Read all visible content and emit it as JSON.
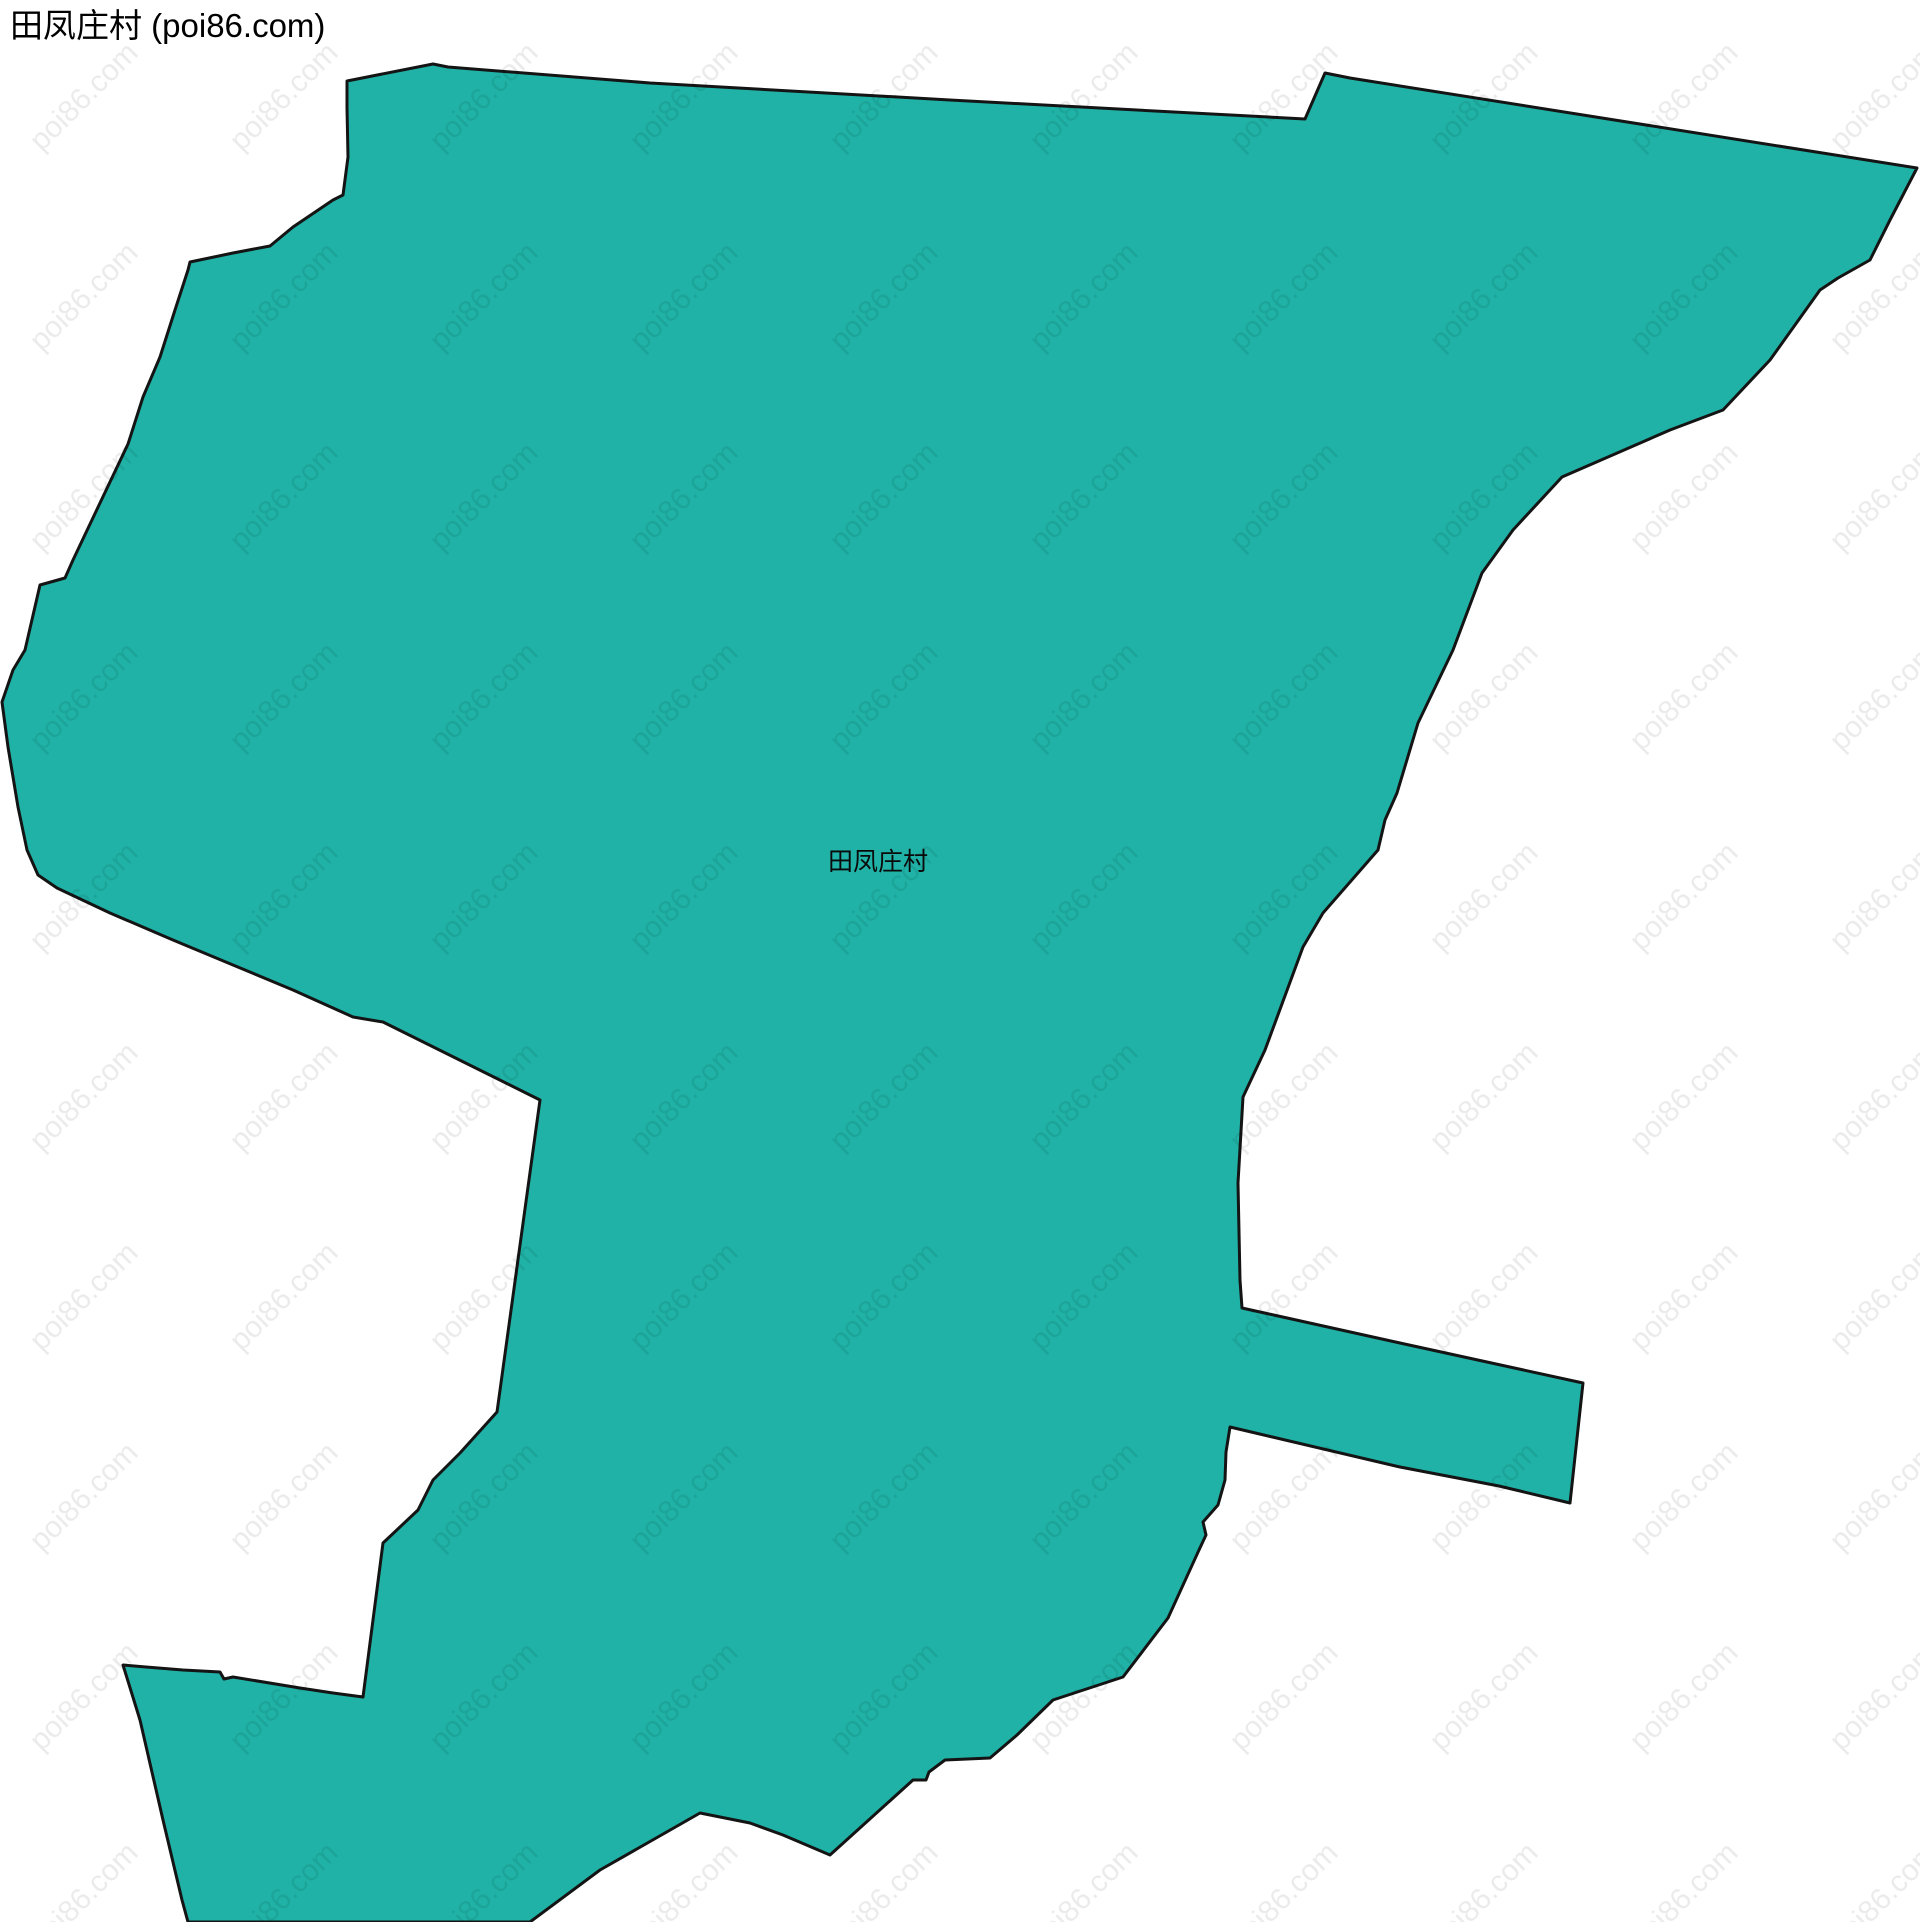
{
  "page": {
    "title": "田凤庄村 (poi86.com)"
  },
  "map": {
    "label": "田凤庄村",
    "region_name": "田凤庄村",
    "region_fill": "#20b2a6",
    "region_stroke": "#141414",
    "region_stroke_width": 3,
    "polygon_points": [
      [
        347,
        81
      ],
      [
        433,
        64
      ],
      [
        448,
        67
      ],
      [
        650,
        83
      ],
      [
        950,
        100
      ],
      [
        1305,
        119
      ],
      [
        1325,
        73
      ],
      [
        1350,
        78
      ],
      [
        1917,
        168
      ],
      [
        1890,
        220
      ],
      [
        1870,
        260
      ],
      [
        1838,
        278
      ],
      [
        1820,
        290
      ],
      [
        1770,
        360
      ],
      [
        1723,
        410
      ],
      [
        1670,
        430
      ],
      [
        1562,
        477
      ],
      [
        1513,
        530
      ],
      [
        1482,
        573
      ],
      [
        1453,
        650
      ],
      [
        1418,
        723
      ],
      [
        1397,
        793
      ],
      [
        1385,
        820
      ],
      [
        1378,
        850
      ],
      [
        1323,
        913
      ],
      [
        1303,
        947
      ],
      [
        1265,
        1050
      ],
      [
        1243,
        1097
      ],
      [
        1238,
        1183
      ],
      [
        1240,
        1280
      ],
      [
        1242,
        1308
      ],
      [
        1400,
        1343
      ],
      [
        1583,
        1383
      ],
      [
        1570,
        1503
      ],
      [
        1499,
        1486
      ],
      [
        1400,
        1467
      ],
      [
        1230,
        1427
      ],
      [
        1226,
        1452
      ],
      [
        1225,
        1480
      ],
      [
        1218,
        1505
      ],
      [
        1203,
        1522
      ],
      [
        1206,
        1535
      ],
      [
        1199,
        1550
      ],
      [
        1168,
        1618
      ],
      [
        1123,
        1677
      ],
      [
        1053,
        1700
      ],
      [
        1017,
        1735
      ],
      [
        990,
        1758
      ],
      [
        945,
        1760
      ],
      [
        929,
        1772
      ],
      [
        926,
        1780
      ],
      [
        913,
        1780
      ],
      [
        830,
        1855
      ],
      [
        783,
        1835
      ],
      [
        750,
        1823
      ],
      [
        700,
        1813
      ],
      [
        600,
        1870
      ],
      [
        530,
        1922
      ],
      [
        188,
        1922
      ],
      [
        182,
        1900
      ],
      [
        163,
        1820
      ],
      [
        140,
        1720
      ],
      [
        123,
        1665
      ],
      [
        146,
        1667
      ],
      [
        183,
        1670
      ],
      [
        220,
        1672
      ],
      [
        224,
        1679
      ],
      [
        233,
        1677
      ],
      [
        300,
        1688
      ],
      [
        333,
        1693
      ],
      [
        363,
        1697
      ],
      [
        383,
        1543
      ],
      [
        418,
        1510
      ],
      [
        433,
        1480
      ],
      [
        460,
        1453
      ],
      [
        497,
        1412
      ],
      [
        540,
        1100
      ],
      [
        383,
        1022
      ],
      [
        353,
        1017
      ],
      [
        293,
        990
      ],
      [
        233,
        965
      ],
      [
        173,
        940
      ],
      [
        110,
        913
      ],
      [
        57,
        888
      ],
      [
        38,
        875
      ],
      [
        27,
        850
      ],
      [
        18,
        807
      ],
      [
        8,
        747
      ],
      [
        2,
        702
      ],
      [
        13,
        670
      ],
      [
        25,
        650
      ],
      [
        40,
        585
      ],
      [
        65,
        578
      ],
      [
        73,
        560
      ],
      [
        100,
        503
      ],
      [
        128,
        444
      ],
      [
        143,
        397
      ],
      [
        160,
        357
      ],
      [
        175,
        310
      ],
      [
        188,
        270
      ],
      [
        190,
        262
      ],
      [
        233,
        253
      ],
      [
        270,
        246
      ],
      [
        293,
        227
      ],
      [
        333,
        200
      ],
      [
        343,
        195
      ],
      [
        348,
        157
      ],
      [
        347,
        108
      ]
    ],
    "label_position": {
      "x": 828,
      "y": 842
    }
  },
  "watermark": {
    "text": "poi86.com",
    "color": "rgba(0,0,0,0.08)",
    "font_size": 30,
    "rotation_deg": -45,
    "grid": {
      "x_start": 100,
      "y_start": 30,
      "pitch_x": 200,
      "pitch_y": 200,
      "cols": 10,
      "rows": 10
    }
  }
}
